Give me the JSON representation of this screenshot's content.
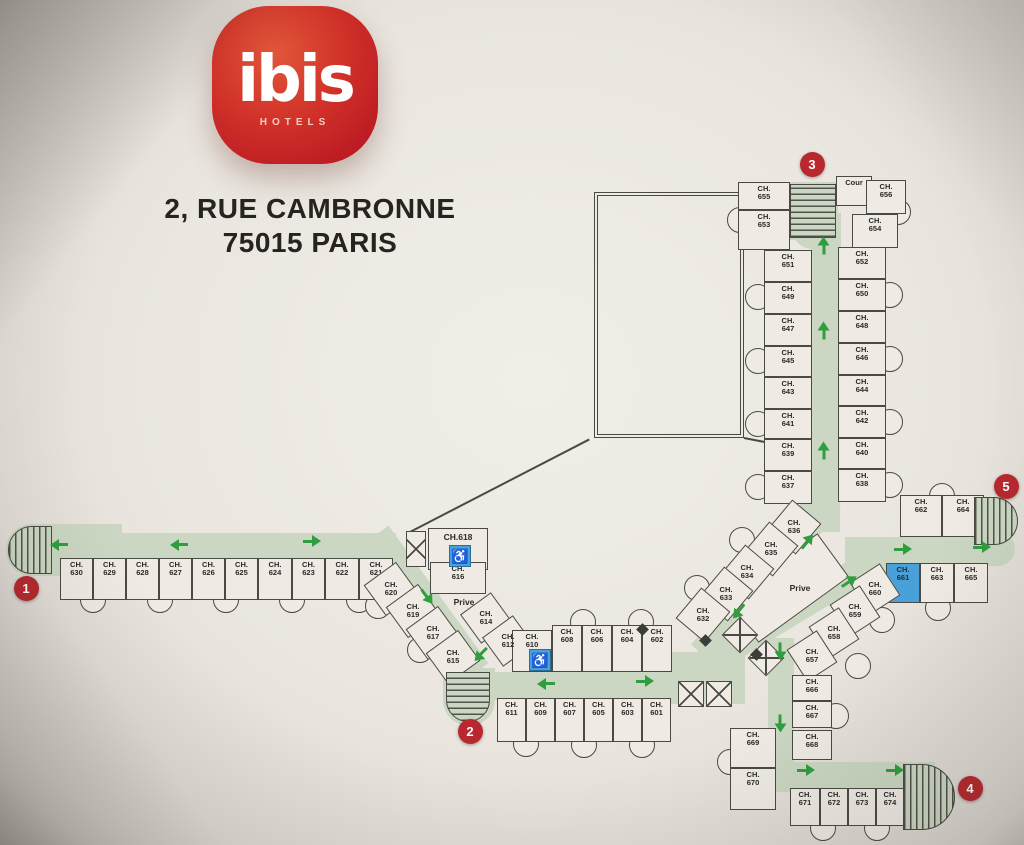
{
  "brand": {
    "name": "ibis",
    "sub": "HOTELS"
  },
  "address": {
    "line1": "2, RUE CAMBRONNE",
    "line2": "75015 PARIS"
  },
  "colors": {
    "background": "#eae6df",
    "line": "#4a4a44",
    "corridor": "#cbd7c2",
    "arrow_green": "#2f9e3f",
    "badge_red": "#b8282e",
    "accessible_blue": "#4aa0d8",
    "logo_red": "#c41f2d",
    "text": "#2a2a28"
  },
  "icons": {
    "wheelchair": "♿"
  },
  "plan": {
    "room_prefix": "CH.",
    "courtyard": {
      "x": 594,
      "y": 192,
      "w": 150,
      "h": 246
    },
    "walls": [
      {
        "x": 408,
        "y": 532,
        "len": 204,
        "deg": -27.3
      },
      {
        "x": 744,
        "y": 437,
        "len": 34,
        "deg": 11
      }
    ],
    "corridors": [
      {
        "x": 14,
        "y": 533,
        "w": 382,
        "h": 26
      },
      {
        "cx": 428,
        "cy": 602,
        "len": 170,
        "h": 26,
        "deg": 54
      },
      {
        "x": 460,
        "y": 672,
        "w": 280,
        "h": 28
      },
      {
        "x": 655,
        "y": 652,
        "w": 90,
        "h": 52
      },
      {
        "cx": 766,
        "cy": 577,
        "len": 200,
        "h": 28,
        "deg": 130
      },
      {
        "x": 811,
        "y": 232,
        "w": 28,
        "h": 280
      },
      {
        "x": 791,
        "y": 213,
        "w": 50,
        "h": 36,
        "br": "0 0 0 22px"
      },
      {
        "cx": 790,
        "cy": 612,
        "len": 215,
        "h": 28,
        "deg": -31
      },
      {
        "x": 768,
        "y": 638,
        "w": 26,
        "h": 140
      },
      {
        "x": 735,
        "y": 762,
        "w": 200,
        "h": 30
      },
      {
        "x": 845,
        "y": 537,
        "w": 142,
        "h": 28
      },
      {
        "x": 955,
        "y": 532,
        "w": 60,
        "h": 34,
        "br": "0 17px 17px 0"
      },
      {
        "x": 6,
        "y": 524,
        "w": 116,
        "h": 52,
        "br": "26px 0 0 26px"
      },
      {
        "x": 800,
        "y": 496,
        "w": 40,
        "h": 36
      },
      {
        "x": 443,
        "y": 668,
        "w": 52,
        "h": 58,
        "br": "0 0 26px 26px"
      },
      {
        "x": 788,
        "y": 182,
        "w": 50,
        "h": 58
      }
    ],
    "stairs": [
      {
        "id": "1",
        "x": 8,
        "y": 526,
        "w": 44,
        "h": 48,
        "br": "24px 0 0 24px",
        "dir": "v"
      },
      {
        "id": "2",
        "x": 446,
        "y": 672,
        "w": 44,
        "h": 50,
        "br": "0 0 22px 22px",
        "dir": "h"
      },
      {
        "id": "3",
        "x": 790,
        "y": 184,
        "w": 46,
        "h": 54,
        "br": "0",
        "dir": "h"
      },
      {
        "id": "4",
        "x": 903,
        "y": 764,
        "w": 52,
        "h": 66,
        "br": "0 33px 33px 0",
        "dir": "v"
      },
      {
        "id": "5",
        "x": 974,
        "y": 497,
        "w": 44,
        "h": 48,
        "br": "0 24px 24px 0",
        "dir": "v"
      }
    ],
    "badges": [
      {
        "n": "1",
        "x": 26,
        "y": 588
      },
      {
        "n": "2",
        "x": 470,
        "y": 731
      },
      {
        "n": "3",
        "x": 812,
        "y": 164
      },
      {
        "n": "4",
        "x": 970,
        "y": 788
      },
      {
        "n": "5",
        "x": 1006,
        "y": 486
      }
    ],
    "elevators": [
      {
        "x": 406,
        "y": 531,
        "w": 20,
        "h": 36
      },
      {
        "cx": 740,
        "cy": 635,
        "w": 26,
        "h": 26,
        "deg": 45
      },
      {
        "cx": 766,
        "cy": 658,
        "w": 26,
        "h": 26,
        "deg": 45
      },
      {
        "x": 678,
        "y": 681,
        "w": 26,
        "h": 26
      },
      {
        "x": 706,
        "y": 681,
        "w": 26,
        "h": 26
      }
    ],
    "access_icons": [
      {
        "x": 449,
        "y": 545,
        "w": 22,
        "h": 22
      },
      {
        "x": 529,
        "y": 649,
        "w": 22,
        "h": 22
      }
    ],
    "labels": [
      {
        "text": "Prive",
        "x": 464,
        "y": 602
      },
      {
        "text": "Prive",
        "x": 800,
        "y": 588
      },
      {
        "text": "CH.618",
        "x": 458,
        "y": 537
      }
    ],
    "prive_box": {
      "cx": 788,
      "cy": 588,
      "w": 112,
      "h": 54,
      "deg": -36
    },
    "diamonds": [
      {
        "x": 642,
        "y": 629
      },
      {
        "x": 705,
        "y": 640
      },
      {
        "x": 756,
        "y": 654
      }
    ],
    "arrows": [
      {
        "x": 58,
        "y": 545,
        "deg": 180
      },
      {
        "x": 178,
        "y": 545,
        "deg": 180
      },
      {
        "x": 312,
        "y": 541,
        "deg": 0
      },
      {
        "x": 427,
        "y": 597,
        "deg": 54
      },
      {
        "x": 480,
        "y": 655,
        "deg": 135
      },
      {
        "x": 545,
        "y": 684,
        "deg": 180
      },
      {
        "x": 645,
        "y": 681,
        "deg": 0
      },
      {
        "x": 807,
        "y": 541,
        "deg": -50
      },
      {
        "x": 738,
        "y": 612,
        "deg": 130
      },
      {
        "x": 849,
        "y": 581,
        "deg": -33
      },
      {
        "x": 780,
        "y": 652,
        "deg": 90
      },
      {
        "x": 780,
        "y": 724,
        "deg": 90
      },
      {
        "x": 806,
        "y": 770,
        "deg": 0
      },
      {
        "x": 895,
        "y": 770,
        "deg": 0
      },
      {
        "x": 903,
        "y": 549,
        "deg": 0
      },
      {
        "x": 982,
        "y": 547,
        "deg": 0
      },
      {
        "x": 823,
        "y": 245,
        "deg": -90
      },
      {
        "x": 823,
        "y": 330,
        "deg": -90
      },
      {
        "x": 823,
        "y": 450,
        "deg": -90
      }
    ],
    "bays": [
      {
        "x": 93,
        "y": 600
      },
      {
        "x": 160,
        "y": 600
      },
      {
        "x": 226,
        "y": 600
      },
      {
        "x": 292,
        "y": 600
      },
      {
        "x": 359,
        "y": 600
      },
      {
        "x": 378,
        "y": 606
      },
      {
        "x": 420,
        "y": 650
      },
      {
        "x": 526,
        "y": 648
      },
      {
        "x": 583,
        "y": 622
      },
      {
        "x": 641,
        "y": 622
      },
      {
        "x": 526,
        "y": 744
      },
      {
        "x": 584,
        "y": 745
      },
      {
        "x": 642,
        "y": 745
      },
      {
        "x": 758,
        "y": 297
      },
      {
        "x": 758,
        "y": 361
      },
      {
        "x": 758,
        "y": 424
      },
      {
        "x": 758,
        "y": 487
      },
      {
        "x": 890,
        "y": 295
      },
      {
        "x": 890,
        "y": 359
      },
      {
        "x": 890,
        "y": 422
      },
      {
        "x": 890,
        "y": 485
      },
      {
        "x": 740,
        "y": 220
      },
      {
        "x": 898,
        "y": 212
      },
      {
        "x": 742,
        "y": 540
      },
      {
        "x": 697,
        "y": 588
      },
      {
        "x": 942,
        "y": 496
      },
      {
        "x": 938,
        "y": 608
      },
      {
        "x": 882,
        "y": 620
      },
      {
        "x": 858,
        "y": 666
      },
      {
        "x": 730,
        "y": 762
      },
      {
        "x": 836,
        "y": 716
      },
      {
        "x": 823,
        "y": 828
      },
      {
        "x": 877,
        "y": 828
      }
    ],
    "rooms": [
      {
        "n": "630",
        "x": 60,
        "y": 558,
        "w": 33,
        "h": 42
      },
      {
        "n": "629",
        "x": 93,
        "y": 558,
        "w": 33,
        "h": 42
      },
      {
        "n": "628",
        "x": 126,
        "y": 558,
        "w": 33,
        "h": 42
      },
      {
        "n": "627",
        "x": 159,
        "y": 558,
        "w": 33,
        "h": 42
      },
      {
        "n": "626",
        "x": 192,
        "y": 558,
        "w": 33,
        "h": 42
      },
      {
        "n": "625",
        "x": 225,
        "y": 558,
        "w": 33,
        "h": 42
      },
      {
        "n": "624",
        "x": 258,
        "y": 558,
        "w": 34,
        "h": 42
      },
      {
        "n": "623",
        "x": 292,
        "y": 558,
        "w": 33,
        "h": 42
      },
      {
        "n": "622",
        "x": 325,
        "y": 558,
        "w": 34,
        "h": 42
      },
      {
        "n": "621",
        "x": 359,
        "y": 558,
        "w": 34,
        "h": 42
      },
      {
        "n": "655",
        "x": 738,
        "y": 182,
        "w": 52,
        "h": 28
      },
      {
        "n": "653",
        "x": 738,
        "y": 210,
        "w": 52,
        "h": 40
      },
      {
        "label": "Cour",
        "plain": true,
        "x": 836,
        "y": 176,
        "w": 36,
        "h": 30
      },
      {
        "n": "656",
        "x": 866,
        "y": 180,
        "w": 40,
        "h": 34
      },
      {
        "n": "654",
        "x": 852,
        "y": 214,
        "w": 46,
        "h": 34
      },
      {
        "n": "651",
        "x": 764,
        "y": 250,
        "w": 48,
        "h": 32
      },
      {
        "n": "649",
        "x": 764,
        "y": 282,
        "w": 48,
        "h": 32
      },
      {
        "n": "647",
        "x": 764,
        "y": 314,
        "w": 48,
        "h": 32
      },
      {
        "n": "645",
        "x": 764,
        "y": 346,
        "w": 48,
        "h": 31
      },
      {
        "n": "643",
        "x": 764,
        "y": 377,
        "w": 48,
        "h": 32
      },
      {
        "n": "641",
        "x": 764,
        "y": 409,
        "w": 48,
        "h": 30
      },
      {
        "n": "639",
        "x": 764,
        "y": 439,
        "w": 48,
        "h": 32
      },
      {
        "n": "637",
        "x": 764,
        "y": 471,
        "w": 48,
        "h": 33
      },
      {
        "n": "652",
        "x": 838,
        "y": 247,
        "w": 48,
        "h": 32
      },
      {
        "n": "650",
        "x": 838,
        "y": 279,
        "w": 48,
        "h": 32
      },
      {
        "n": "648",
        "x": 838,
        "y": 311,
        "w": 48,
        "h": 32
      },
      {
        "n": "646",
        "x": 838,
        "y": 343,
        "w": 48,
        "h": 32
      },
      {
        "n": "644",
        "x": 838,
        "y": 375,
        "w": 48,
        "h": 31
      },
      {
        "n": "642",
        "x": 838,
        "y": 406,
        "w": 48,
        "h": 32
      },
      {
        "n": "640",
        "x": 838,
        "y": 438,
        "w": 48,
        "h": 31
      },
      {
        "n": "638",
        "x": 838,
        "y": 469,
        "w": 48,
        "h": 33
      },
      {
        "n": "636",
        "cx": 794,
        "cy": 527,
        "w": 40,
        "h": 38,
        "deg": -50
      },
      {
        "n": "635",
        "cx": 771,
        "cy": 549,
        "w": 40,
        "h": 38,
        "deg": -50
      },
      {
        "n": "634",
        "cx": 747,
        "cy": 572,
        "w": 40,
        "h": 38,
        "deg": -50
      },
      {
        "n": "633",
        "cx": 726,
        "cy": 594,
        "w": 40,
        "h": 38,
        "deg": -50
      },
      {
        "n": "632",
        "cx": 703,
        "cy": 615,
        "w": 40,
        "h": 38,
        "deg": -50
      },
      {
        "n": "620",
        "cx": 391,
        "cy": 589,
        "w": 38,
        "h": 40,
        "deg": 54
      },
      {
        "n": "619",
        "cx": 413,
        "cy": 611,
        "w": 38,
        "h": 40,
        "deg": 54
      },
      {
        "n": "617",
        "cx": 433,
        "cy": 633,
        "w": 38,
        "h": 40,
        "deg": 54
      },
      {
        "n": "615",
        "cx": 453,
        "cy": 657,
        "w": 38,
        "h": 40,
        "deg": 54
      },
      {
        "n": "614",
        "cx": 486,
        "cy": 618,
        "w": 36,
        "h": 38,
        "deg": 54
      },
      {
        "n": "612",
        "cx": 508,
        "cy": 641,
        "w": 36,
        "h": 38,
        "deg": 54
      },
      {
        "label": "",
        "plain": true,
        "x": 428,
        "y": 528,
        "w": 60,
        "h": 42
      },
      {
        "n": "616",
        "x": 430,
        "y": 562,
        "w": 56,
        "h": 32
      },
      {
        "n": "610",
        "x": 512,
        "y": 630,
        "w": 40,
        "h": 42
      },
      {
        "n": "608",
        "x": 552,
        "y": 625,
        "w": 30,
        "h": 47
      },
      {
        "n": "606",
        "x": 582,
        "y": 625,
        "w": 30,
        "h": 47
      },
      {
        "n": "604",
        "x": 612,
        "y": 625,
        "w": 30,
        "h": 47
      },
      {
        "n": "602",
        "x": 642,
        "y": 625,
        "w": 30,
        "h": 47
      },
      {
        "n": "611",
        "x": 497,
        "y": 698,
        "w": 29,
        "h": 44
      },
      {
        "n": "609",
        "x": 526,
        "y": 698,
        "w": 29,
        "h": 44
      },
      {
        "n": "607",
        "x": 555,
        "y": 698,
        "w": 29,
        "h": 44
      },
      {
        "n": "605",
        "x": 584,
        "y": 698,
        "w": 29,
        "h": 44
      },
      {
        "n": "603",
        "x": 613,
        "y": 698,
        "w": 29,
        "h": 44
      },
      {
        "n": "601",
        "x": 642,
        "y": 698,
        "w": 29,
        "h": 44
      },
      {
        "n": "662",
        "x": 900,
        "y": 495,
        "w": 42,
        "h": 42
      },
      {
        "n": "664",
        "x": 942,
        "y": 495,
        "w": 42,
        "h": 42
      },
      {
        "n": "661",
        "x": 886,
        "y": 563,
        "w": 34,
        "h": 40,
        "blue": true
      },
      {
        "n": "663",
        "x": 920,
        "y": 563,
        "w": 34,
        "h": 40
      },
      {
        "n": "665",
        "x": 954,
        "y": 563,
        "w": 34,
        "h": 40
      },
      {
        "n": "660",
        "cx": 875,
        "cy": 589,
        "w": 36,
        "h": 38,
        "deg": -33
      },
      {
        "n": "659",
        "cx": 855,
        "cy": 611,
        "w": 36,
        "h": 38,
        "deg": -33
      },
      {
        "n": "658",
        "cx": 834,
        "cy": 633,
        "w": 36,
        "h": 38,
        "deg": -33
      },
      {
        "n": "657",
        "cx": 812,
        "cy": 656,
        "w": 36,
        "h": 38,
        "deg": -33
      },
      {
        "n": "666",
        "x": 792,
        "y": 675,
        "w": 40,
        "h": 26
      },
      {
        "n": "667",
        "x": 792,
        "y": 701,
        "w": 40,
        "h": 27
      },
      {
        "n": "668",
        "x": 792,
        "y": 730,
        "w": 40,
        "h": 30
      },
      {
        "n": "669",
        "x": 730,
        "y": 728,
        "w": 46,
        "h": 40
      },
      {
        "n": "670",
        "x": 730,
        "y": 768,
        "w": 46,
        "h": 42
      },
      {
        "n": "671",
        "x": 790,
        "y": 788,
        "w": 30,
        "h": 38
      },
      {
        "n": "672",
        "x": 820,
        "y": 788,
        "w": 28,
        "h": 38
      },
      {
        "n": "673",
        "x": 848,
        "y": 788,
        "w": 28,
        "h": 38
      },
      {
        "n": "674",
        "x": 876,
        "y": 788,
        "w": 28,
        "h": 38
      }
    ]
  }
}
